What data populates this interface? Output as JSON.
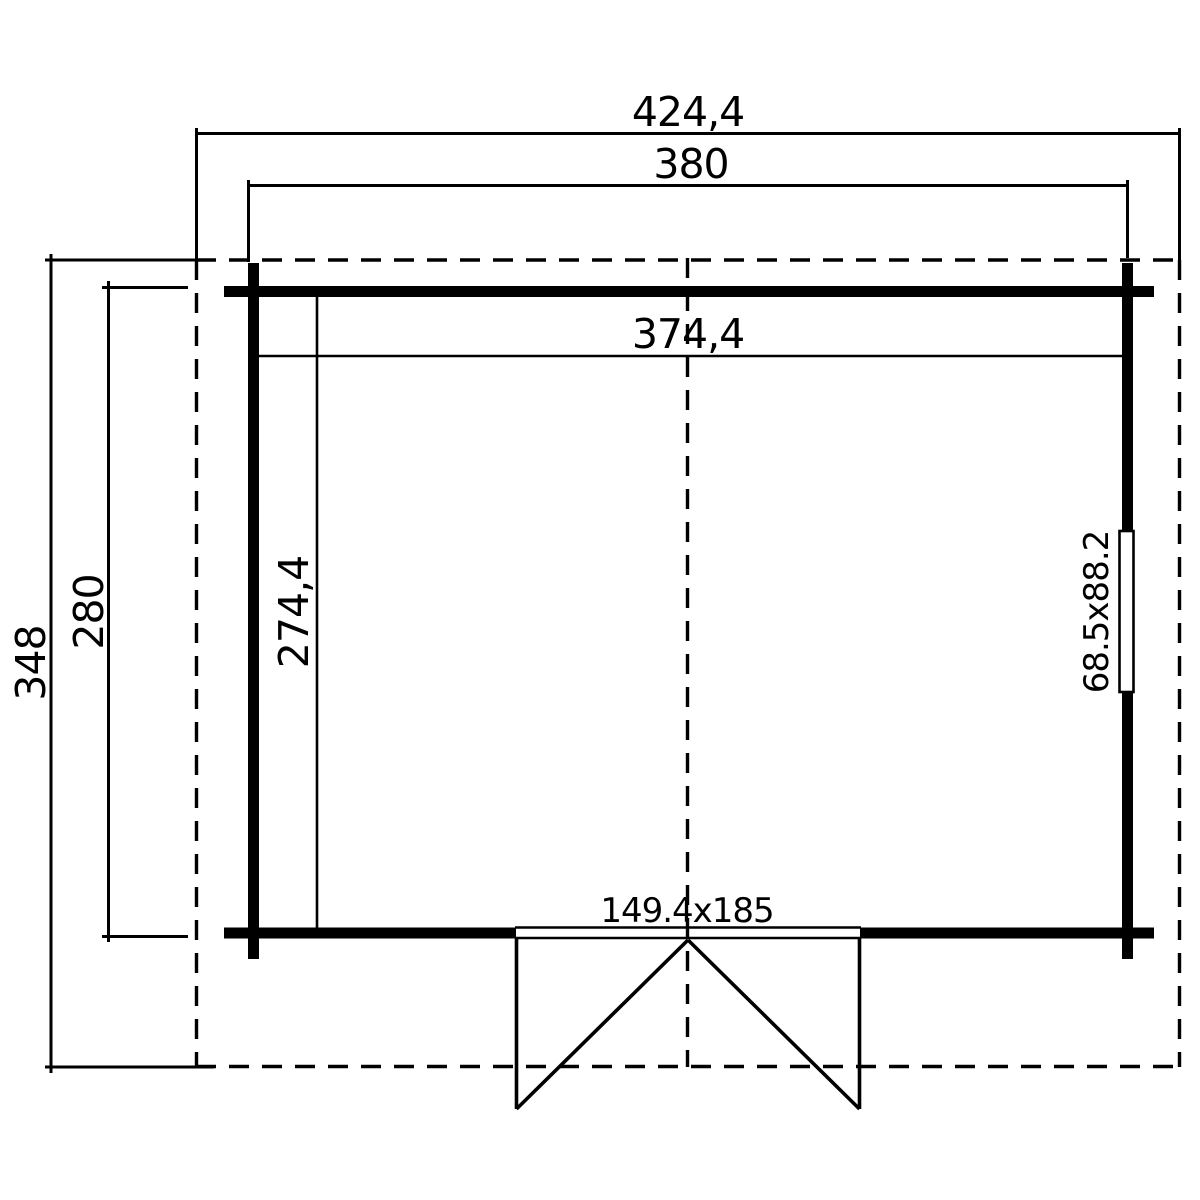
{
  "colors": {
    "line": "#000000",
    "background": "#ffffff"
  },
  "plan": {
    "overall": {
      "width_label": "424,4",
      "depth_label": "348"
    },
    "walls_outer": {
      "width_label": "380",
      "depth_label": "280"
    },
    "interior": {
      "width_label": "374,4",
      "depth_label": "274,4"
    },
    "window": {
      "size_label": "68.5x88.2"
    },
    "door": {
      "size_label": "149.4x185"
    }
  }
}
